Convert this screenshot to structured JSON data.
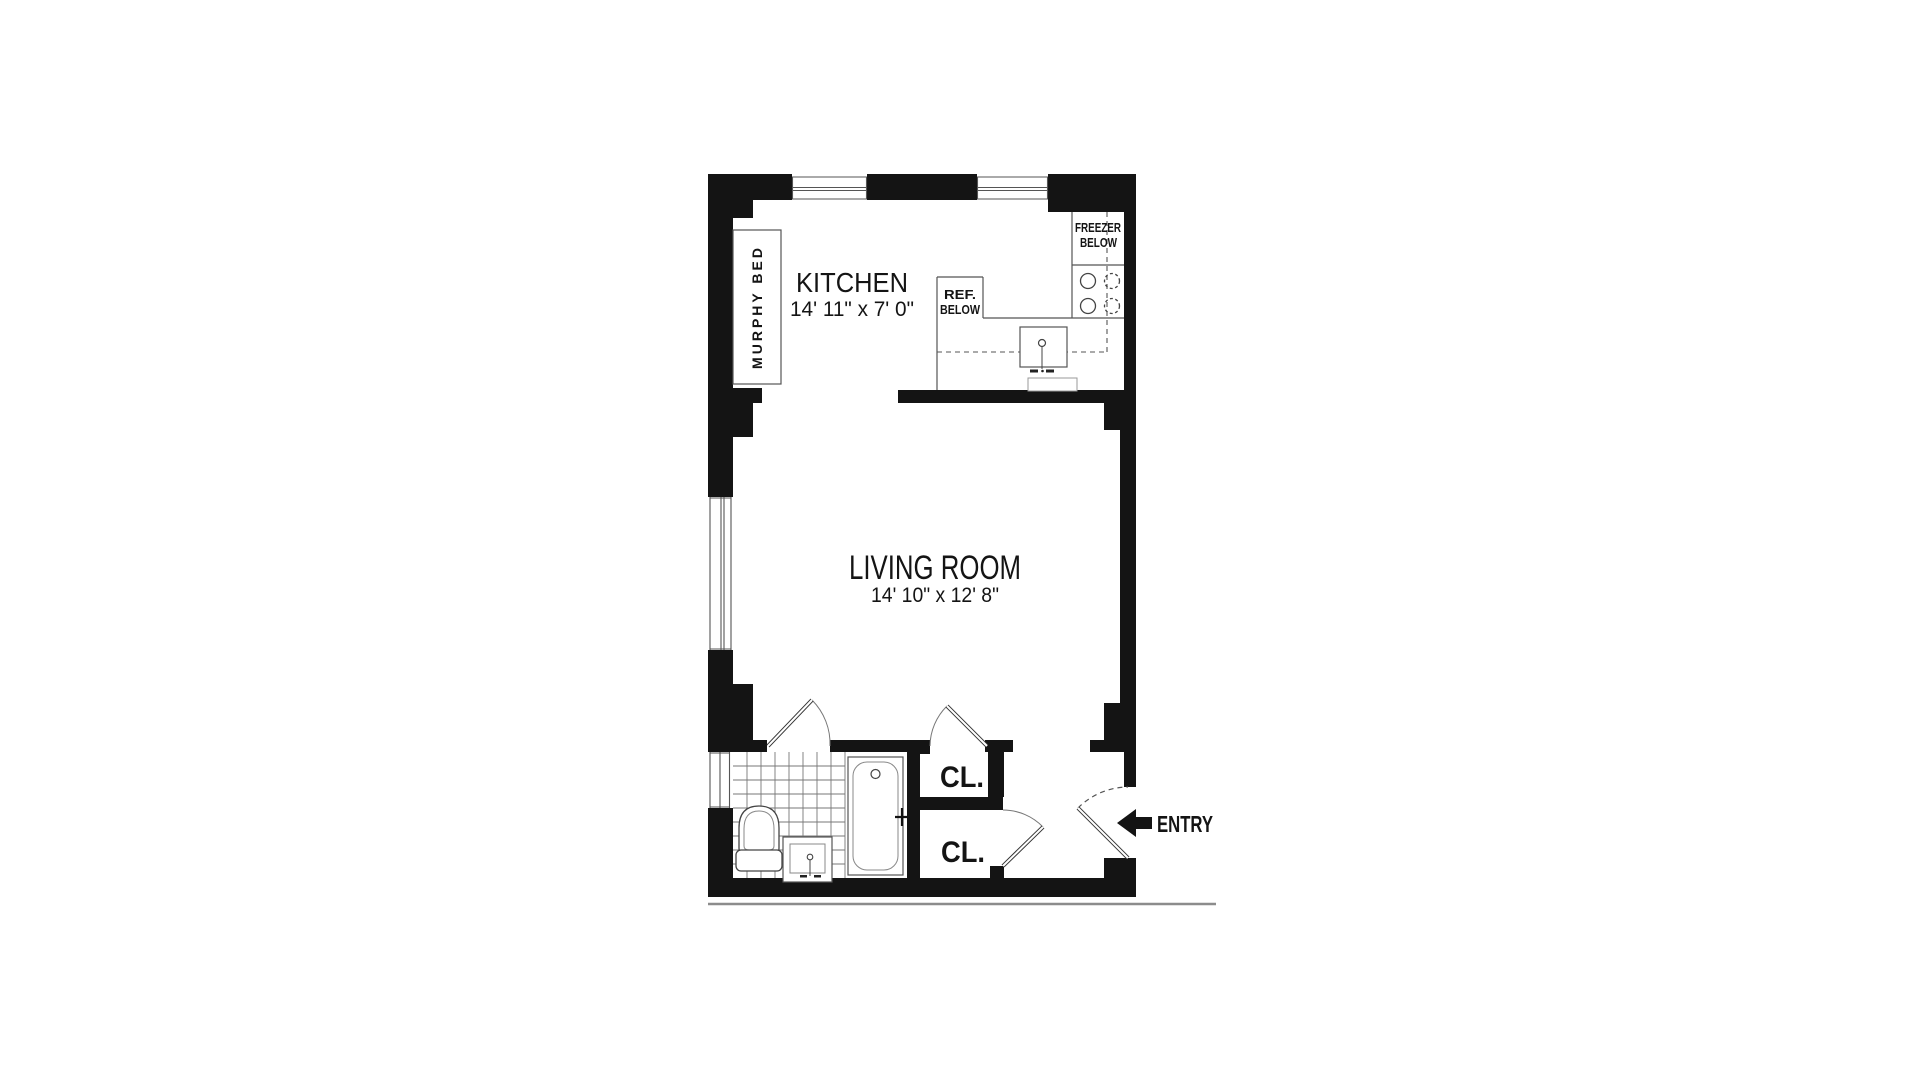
{
  "floor_plan": {
    "kitchen": {
      "label": "KITCHEN",
      "dimensions": "14' 11\" x 7' 0\""
    },
    "living_room": {
      "label": "LIVING ROOM",
      "dimensions": "14' 10\" x 12' 8\""
    },
    "murphy_bed": {
      "label": "MURPHY BED"
    },
    "freezer": {
      "line1": "FREEZER",
      "line2": "BELOW"
    },
    "refrigerator": {
      "line1": "REF.",
      "line2": "BELOW"
    },
    "closet_upper": {
      "label": "CL."
    },
    "closet_lower": {
      "label": "CL."
    },
    "entry": {
      "label": "ENTRY"
    },
    "colors": {
      "wall": "#141414",
      "fixture_line": "#555555",
      "text": "#141414",
      "background": "#ffffff"
    }
  }
}
